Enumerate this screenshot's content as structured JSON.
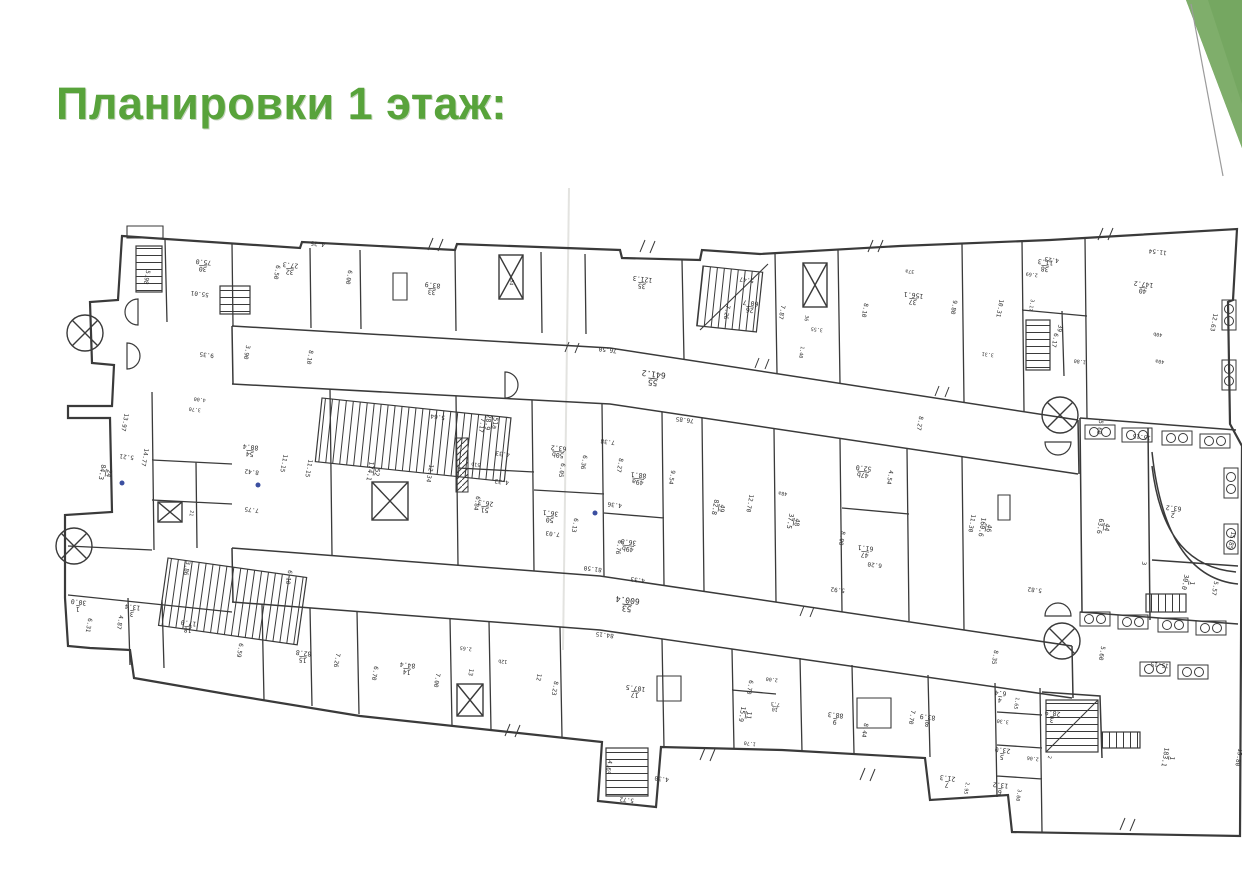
{
  "slide": {
    "title": "Планировки 1 этаж:",
    "title_color": "#58a33b",
    "background": "#ffffff",
    "accent": {
      "triangle_main": "#75a761",
      "triangle_light": "#7fae6b",
      "triangle_dark": "#699a53",
      "line_color": "#9b9b9b"
    }
  },
  "floorplan": {
    "name": "first-floor-plan",
    "ink": "#3a3a3a",
    "scan_line_color": "#e3e3e0",
    "accent_dot_color": "#3b4fa0",
    "labels": [
      {
        "t": "30/75.0",
        "x": 203,
        "y": 267,
        "r": 186
      },
      {
        "t": "32/27.3",
        "x": 290,
        "y": 270,
        "r": 186
      },
      {
        "t": "33/83.9",
        "x": 432,
        "y": 290,
        "r": 187
      },
      {
        "t": "34",
        "x": 510,
        "y": 282,
        "r": 100,
        "s": 5
      },
      {
        "t": "35/121.3",
        "x": 642,
        "y": 284,
        "r": 187
      },
      {
        "t": "26/60.7",
        "x": 750,
        "y": 308,
        "r": 187
      },
      {
        "t": "37a",
        "x": 910,
        "y": 270,
        "r": 187,
        "s": 5
      },
      {
        "t": "37/156.1",
        "x": 913,
        "y": 300,
        "r": 187
      },
      {
        "t": "36",
        "x": 805,
        "y": 318,
        "r": 100,
        "s": 5
      },
      {
        "t": "38/11.3",
        "x": 1045,
        "y": 267,
        "r": 187
      },
      {
        "t": "39",
        "x": 1058,
        "y": 328,
        "r": 100,
        "s": 6
      },
      {
        "t": "40/147.2",
        "x": 1143,
        "y": 289,
        "r": 187
      },
      {
        "t": "40b",
        "x": 1158,
        "y": 333,
        "r": 187,
        "s": 5
      },
      {
        "t": "40a",
        "x": 1160,
        "y": 360,
        "r": 187,
        "s": 5
      },
      {
        "t": "24/84.3",
        "x": 107,
        "y": 473,
        "r": 100
      },
      {
        "t": "54/80.4",
        "x": 250,
        "y": 452,
        "r": 187
      },
      {
        "t": "52/174.1",
        "x": 375,
        "y": 472,
        "r": 100
      },
      {
        "t": "51a/28.9",
        "x": 493,
        "y": 423,
        "r": 97
      },
      {
        "t": "51b",
        "x": 476,
        "y": 463,
        "r": 187,
        "s": 5
      },
      {
        "t": "51/26.3",
        "x": 485,
        "y": 508,
        "r": 187
      },
      {
        "t": "50b/63.2",
        "x": 558,
        "y": 453,
        "r": 187
      },
      {
        "t": "50/36.1",
        "x": 550,
        "y": 518,
        "r": 187
      },
      {
        "t": "49a/88.1",
        "x": 638,
        "y": 480,
        "r": 187
      },
      {
        "t": "49b/36.8",
        "x": 628,
        "y": 547,
        "r": 187
      },
      {
        "t": "49/82.8",
        "x": 720,
        "y": 508,
        "r": 100
      },
      {
        "t": "48/37.5",
        "x": 795,
        "y": 522,
        "r": 100
      },
      {
        "t": "48a",
        "x": 783,
        "y": 492,
        "r": 187,
        "s": 5
      },
      {
        "t": "47b/52.0",
        "x": 863,
        "y": 473,
        "r": 187
      },
      {
        "t": "47/61.1",
        "x": 865,
        "y": 553,
        "r": 187
      },
      {
        "t": "46/160.6",
        "x": 987,
        "y": 528,
        "r": 100
      },
      {
        "t": "44/63.6",
        "x": 1105,
        "y": 527,
        "r": 100
      },
      {
        "t": "2/63.2",
        "x": 1173,
        "y": 513,
        "r": 187
      },
      {
        "t": "3",
        "x": 1142,
        "y": 563,
        "r": 100,
        "s": 6
      },
      {
        "t": "1/30.0",
        "x": 1190,
        "y": 583,
        "r": 100
      },
      {
        "t": "55/641.2",
        "x": 653,
        "y": 380,
        "r": 187,
        "s": 8
      },
      {
        "t": "53/600.4",
        "x": 627,
        "y": 606,
        "r": 187,
        "s": 8
      },
      {
        "t": "21",
        "x": 190,
        "y": 513,
        "r": 100,
        "s": 5
      },
      {
        "t": "1/30.0",
        "x": 78,
        "y": 607,
        "r": 187
      },
      {
        "t": "3/13.4",
        "x": 132,
        "y": 612,
        "r": 187
      },
      {
        "t": "18/17.0",
        "x": 188,
        "y": 628,
        "r": 187
      },
      {
        "t": "15/82.8",
        "x": 303,
        "y": 658,
        "r": 187
      },
      {
        "t": "14/84.4",
        "x": 407,
        "y": 670,
        "r": 187
      },
      {
        "t": "13",
        "x": 469,
        "y": 672,
        "r": 100,
        "s": 6
      },
      {
        "t": "12b",
        "x": 503,
        "y": 660,
        "r": 187,
        "s": 5
      },
      {
        "t": "12",
        "x": 537,
        "y": 677,
        "r": 100,
        "s": 6
      },
      {
        "t": "17/107.5",
        "x": 635,
        "y": 693,
        "r": 187
      },
      {
        "t": "9/88.3",
        "x": 835,
        "y": 720,
        "r": 187
      },
      {
        "t": "8/83.9",
        "x": 927,
        "y": 722,
        "r": 187
      },
      {
        "t": "11/15.9",
        "x": 747,
        "y": 715,
        "r": 100
      },
      {
        "t": "10/7.3",
        "x": 775,
        "y": 708,
        "r": 187,
        "s": 5
      },
      {
        "t": "7/21.3",
        "x": 947,
        "y": 783,
        "r": 187
      },
      {
        "t": "4/6.4",
        "x": 1000,
        "y": 698,
        "r": 187
      },
      {
        "t": "5/23.0",
        "x": 1002,
        "y": 755,
        "r": 187
      },
      {
        "t": "6/13.2",
        "x": 1000,
        "y": 790,
        "r": 187
      },
      {
        "t": "3/28.9",
        "x": 1052,
        "y": 718,
        "r": 187
      },
      {
        "t": "2",
        "x": 1048,
        "y": 757,
        "r": 100,
        "s": 5
      },
      {
        "t": "1/183.1",
        "x": 1170,
        "y": 758,
        "r": 100
      },
      {
        "t": "55.01",
        "x": 200,
        "y": 292,
        "r": 187
      },
      {
        "t": "5.98",
        "x": 145,
        "y": 277,
        "r": 100
      },
      {
        "t": "4.25",
        "x": 318,
        "y": 242,
        "r": 187
      },
      {
        "t": "6.50",
        "x": 275,
        "y": 272,
        "r": 100
      },
      {
        "t": "6.00",
        "x": 347,
        "y": 277,
        "r": 100
      },
      {
        "t": "3.90",
        "x": 245,
        "y": 352,
        "r": 100
      },
      {
        "t": "9.35",
        "x": 207,
        "y": 353,
        "r": 187
      },
      {
        "t": "8.10",
        "x": 308,
        "y": 357,
        "r": 100
      },
      {
        "t": "76.50",
        "x": 608,
        "y": 348,
        "r": 187
      },
      {
        "t": "5.47",
        "x": 747,
        "y": 278,
        "r": 187
      },
      {
        "t": "7.26",
        "x": 725,
        "y": 312,
        "r": 100
      },
      {
        "t": "7.87",
        "x": 780,
        "y": 312,
        "r": 100
      },
      {
        "t": "8.10",
        "x": 863,
        "y": 310,
        "r": 100
      },
      {
        "t": "9.80",
        "x": 952,
        "y": 307,
        "r": 100
      },
      {
        "t": "10.31",
        "x": 998,
        "y": 308,
        "r": 100
      },
      {
        "t": "3.17",
        "x": 1030,
        "y": 305,
        "r": 100,
        "s": 5
      },
      {
        "t": "2.69",
        "x": 1032,
        "y": 273,
        "r": 187,
        "s": 5
      },
      {
        "t": "4.23",
        "x": 1052,
        "y": 258,
        "r": 187
      },
      {
        "t": "11.54",
        "x": 1158,
        "y": 250,
        "r": 187
      },
      {
        "t": "12.63",
        "x": 1212,
        "y": 322,
        "r": 100
      },
      {
        "t": "1.80",
        "x": 1080,
        "y": 360,
        "r": 187,
        "s": 5
      },
      {
        "t": "6.17",
        "x": 1053,
        "y": 340,
        "r": 100
      },
      {
        "t": "3.31",
        "x": 988,
        "y": 353,
        "r": 187,
        "s": 5
      },
      {
        "t": "3.55",
        "x": 817,
        "y": 328,
        "r": 187,
        "s": 5
      },
      {
        "t": "1.40",
        "x": 800,
        "y": 352,
        "r": 100,
        "s": 5
      },
      {
        "t": "13.97",
        "x": 123,
        "y": 422,
        "r": 100
      },
      {
        "t": "5.21",
        "x": 127,
        "y": 455,
        "r": 187
      },
      {
        "t": "14.77",
        "x": 143,
        "y": 457,
        "r": 100
      },
      {
        "t": "11.15",
        "x": 282,
        "y": 463,
        "r": 100
      },
      {
        "t": "11.15",
        "x": 307,
        "y": 468,
        "r": 100
      },
      {
        "t": "8.42",
        "x": 252,
        "y": 470,
        "r": 187
      },
      {
        "t": "7.75",
        "x": 252,
        "y": 508,
        "r": 187
      },
      {
        "t": "6.10",
        "x": 287,
        "y": 577,
        "r": 100
      },
      {
        "t": "3.86",
        "x": 185,
        "y": 568,
        "r": 100
      },
      {
        "t": "4.00",
        "x": 200,
        "y": 398,
        "r": 187,
        "s": 5
      },
      {
        "t": "3.70",
        "x": 195,
        "y": 408,
        "r": 187,
        "s": 5
      },
      {
        "t": "12.34",
        "x": 428,
        "y": 473,
        "r": 100
      },
      {
        "t": "5.64",
        "x": 438,
        "y": 415,
        "r": 187
      },
      {
        "t": "7.17",
        "x": 480,
        "y": 425,
        "r": 100
      },
      {
        "t": "4.33",
        "x": 503,
        "y": 452,
        "r": 187
      },
      {
        "t": "4.32",
        "x": 502,
        "y": 480,
        "r": 187
      },
      {
        "t": "6.84",
        "x": 475,
        "y": 503,
        "r": 100
      },
      {
        "t": "6.05",
        "x": 560,
        "y": 470,
        "r": 100
      },
      {
        "t": "6.36",
        "x": 582,
        "y": 462,
        "r": 100
      },
      {
        "t": "7.38",
        "x": 608,
        "y": 440,
        "r": 187
      },
      {
        "t": "8.27",
        "x": 618,
        "y": 465,
        "r": 100
      },
      {
        "t": "9.54",
        "x": 670,
        "y": 477,
        "r": 100
      },
      {
        "t": "6.13",
        "x": 573,
        "y": 525,
        "r": 100
      },
      {
        "t": "7.03",
        "x": 553,
        "y": 532,
        "r": 187
      },
      {
        "t": "4.36",
        "x": 615,
        "y": 503,
        "r": 187
      },
      {
        "t": "6.76",
        "x": 617,
        "y": 547,
        "r": 100
      },
      {
        "t": "81.50",
        "x": 593,
        "y": 567,
        "r": 187
      },
      {
        "t": "4.33",
        "x": 638,
        "y": 578,
        "r": 187
      },
      {
        "t": "76.85",
        "x": 685,
        "y": 418,
        "r": 187
      },
      {
        "t": "8.27",
        "x": 918,
        "y": 423,
        "r": 100
      },
      {
        "t": "12.70",
        "x": 748,
        "y": 503,
        "r": 100
      },
      {
        "t": "4.54",
        "x": 888,
        "y": 477,
        "r": 100
      },
      {
        "t": "8.00",
        "x": 840,
        "y": 538,
        "r": 100
      },
      {
        "t": "6.20",
        "x": 875,
        "y": 563,
        "r": 187
      },
      {
        "t": "11.30",
        "x": 970,
        "y": 523,
        "r": 100
      },
      {
        "t": "5.92",
        "x": 838,
        "y": 588,
        "r": 187
      },
      {
        "t": "8.35",
        "x": 993,
        "y": 657,
        "r": 100
      },
      {
        "t": "5.60",
        "x": 1098,
        "y": 427,
        "r": 100
      },
      {
        "t": "15.15",
        "x": 1142,
        "y": 435,
        "r": 187
      },
      {
        "t": "15.85",
        "x": 1230,
        "y": 540,
        "r": 100
      },
      {
        "t": "5.57",
        "x": 1213,
        "y": 588,
        "r": 100
      },
      {
        "t": "5.82",
        "x": 1035,
        "y": 588,
        "r": 187
      },
      {
        "t": "84.15",
        "x": 605,
        "y": 633,
        "r": 187
      },
      {
        "t": "6.59",
        "x": 238,
        "y": 650,
        "r": 100
      },
      {
        "t": "7.26",
        "x": 335,
        "y": 660,
        "r": 100
      },
      {
        "t": "6.31",
        "x": 87,
        "y": 625,
        "r": 100
      },
      {
        "t": "4.87",
        "x": 118,
        "y": 622,
        "r": 100
      },
      {
        "t": "6.70",
        "x": 373,
        "y": 673,
        "r": 100
      },
      {
        "t": "7.00",
        "x": 435,
        "y": 680,
        "r": 100
      },
      {
        "t": "2.65",
        "x": 466,
        "y": 647,
        "r": 187,
        "s": 5
      },
      {
        "t": "8.23",
        "x": 553,
        "y": 688,
        "r": 100
      },
      {
        "t": "4.65",
        "x": 607,
        "y": 767,
        "r": 100
      },
      {
        "t": "4.30",
        "x": 662,
        "y": 777,
        "r": 187
      },
      {
        "t": "5.72",
        "x": 627,
        "y": 798,
        "r": 187
      },
      {
        "t": "8.44",
        "x": 863,
        "y": 730,
        "r": 100
      },
      {
        "t": "7.70",
        "x": 910,
        "y": 717,
        "r": 100
      },
      {
        "t": "2.00",
        "x": 772,
        "y": 678,
        "r": 187,
        "s": 5
      },
      {
        "t": "6.70",
        "x": 748,
        "y": 687,
        "r": 100
      },
      {
        "t": "1.70",
        "x": 750,
        "y": 742,
        "r": 187,
        "s": 5
      },
      {
        "t": "2.95",
        "x": 965,
        "y": 788,
        "r": 100,
        "s": 5
      },
      {
        "t": "15.80",
        "x": 1237,
        "y": 757,
        "r": 100
      },
      {
        "t": "15.15",
        "x": 1160,
        "y": 663,
        "r": 187
      },
      {
        "t": "5.60",
        "x": 1100,
        "y": 653,
        "r": 100
      },
      {
        "t": "3.00",
        "x": 1017,
        "y": 795,
        "r": 100,
        "s": 5
      },
      {
        "t": "2.06",
        "x": 1033,
        "y": 757,
        "r": 187,
        "s": 5
      },
      {
        "t": "1.65",
        "x": 1015,
        "y": 703,
        "r": 100,
        "s": 5
      },
      {
        "t": "3.30",
        "x": 1003,
        "y": 720,
        "r": 187,
        "s": 5
      }
    ]
  }
}
